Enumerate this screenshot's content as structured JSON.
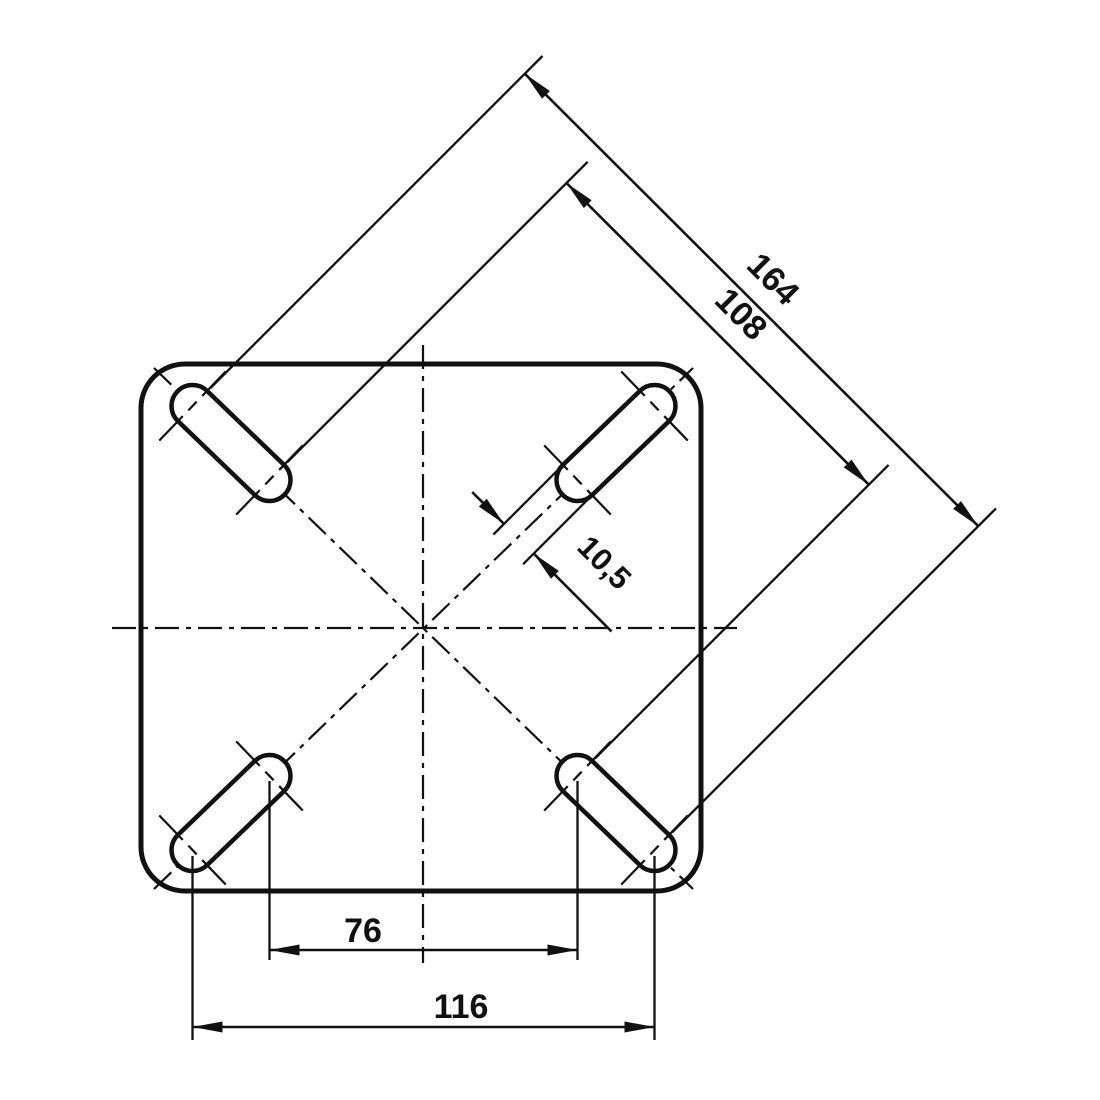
{
  "drawing": {
    "background": "#ffffff",
    "line_color": "#111111",
    "labels": {
      "dim_diagonal_outer": "164",
      "dim_diagonal_inner": "108",
      "dim_slot_width": "10,5",
      "dim_bolt_spacing": "76",
      "dim_outer_spacing": "116"
    }
  }
}
